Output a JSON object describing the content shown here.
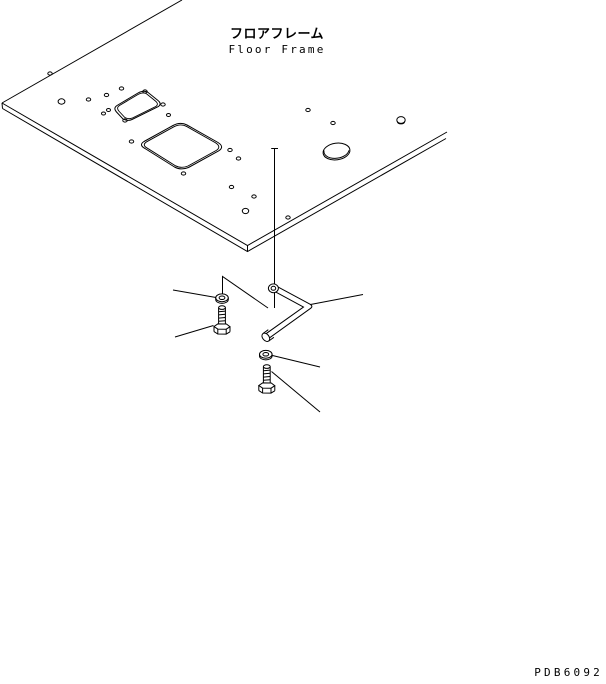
{
  "window": {
    "width": 606,
    "height": 684,
    "background": "#ffffff",
    "line_color": "#000000"
  },
  "header": {
    "title_ja": "フロアフレーム",
    "title_en": "Floor Frame"
  },
  "footer": {
    "drawing_code": "PDB6092"
  },
  "diagram": {
    "type": "exploded-isometric-parts-drawing",
    "parts": [
      "floor-frame-panel",
      "panel-opening-small",
      "panel-opening-large",
      "bent-mounting-tube",
      "washer-upper",
      "hex-bolt-upper",
      "washer-lower",
      "hex-bolt-lower"
    ]
  }
}
